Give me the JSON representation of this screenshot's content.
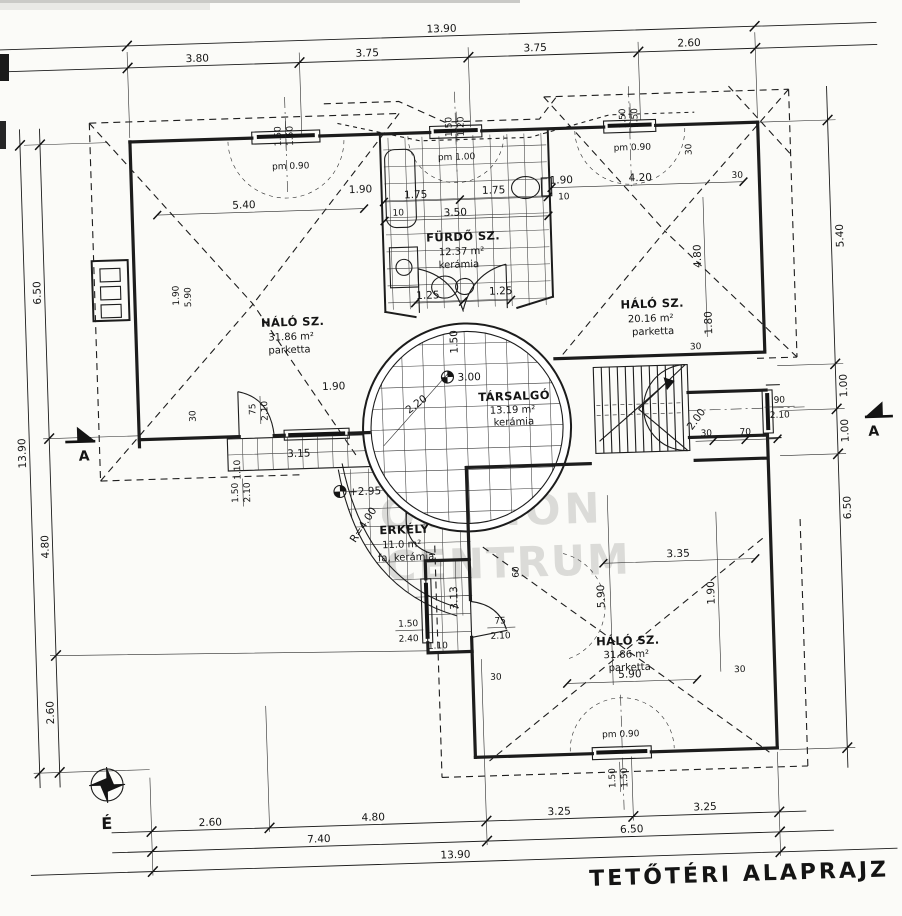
{
  "title": "TETŐTÉRI ALAPRAJZ",
  "compass_label": "É",
  "section_marker": "A",
  "watermark": {
    "logo": "OC",
    "line1": "OTTHON",
    "line2": "CENTRUM"
  },
  "rooms": {
    "bedroom_nw": {
      "name": "HÁLÓ SZ.",
      "area": "31.86 m²",
      "floor": "parketta"
    },
    "bathroom": {
      "name": "FÜRDŐ SZ.",
      "area": "12.37 m²",
      "floor": "kerámia"
    },
    "bedroom_ne": {
      "name": "HÁLÓ SZ.",
      "area": "20.16 m²",
      "floor": "parketta"
    },
    "lounge": {
      "name": "TÁRSALGÓ",
      "area": "13.19 m²",
      "floor": "kerámia"
    },
    "balcony": {
      "name": "ERKÉLY",
      "area": "11.0 m²",
      "floor": "fa, kerámia"
    },
    "bedroom_s": {
      "name": "HÁLÓ SZ.",
      "area": "31.86 m²",
      "floor": "parketta"
    }
  },
  "dims": {
    "top_overall": "13.90",
    "top": [
      "3.80",
      "3.75",
      "3.75",
      "2.60"
    ],
    "left_overall": "13.90",
    "left": [
      "6.50",
      "4.80",
      "2.60"
    ],
    "right": [
      "5.40",
      "1.00",
      "1.00",
      "6.50"
    ],
    "bottom_row1": [
      "2.60",
      "4.80",
      "3.25",
      "3.25"
    ],
    "bottom_row2": [
      "7.40",
      "6.50"
    ],
    "bottom_overall": "13.90"
  },
  "openings": {
    "win_nw": {
      "w": "1.50",
      "h": "1.50",
      "sill": "pm 0.90"
    },
    "win_bath": {
      "w": "1.50",
      "h": "1.20",
      "sill": "pm 1.00"
    },
    "win_ne": {
      "w": "1.50",
      "h": "1.50",
      "sill": "pm 0.90"
    },
    "win_s": {
      "w": "1.50",
      "h": "1.50",
      "sill": "pm 0.90"
    },
    "door_terrace": {
      "w": "75",
      "h": "2.10"
    },
    "win_terrace": {
      "w": "1.50",
      "h": "2.10"
    },
    "door_balcony": {
      "w": "75",
      "h": "2.10"
    },
    "win_balcony": {
      "w": "1.50",
      "h": "2.40"
    },
    "win_stair": {
      "w": "90",
      "h": "2.10"
    }
  },
  "marks": {
    "level_lounge": "3.00",
    "level_balcony": "+2.95",
    "radius": "R=4.00",
    "stair_run": "2.00",
    "lounge_diag": "2.20"
  },
  "inline": {
    "nw": {
      "width": "5.40",
      "d190": "1.90",
      "d10": "10",
      "d190b": "1.90",
      "d590": "5.90"
    },
    "bath": {
      "left": "1.75",
      "right": "1.75",
      "width": "3.50",
      "d190": "1.90",
      "d10": "10"
    },
    "ne": {
      "width": "4.20",
      "t30_top": "30",
      "t30_right": "30",
      "t30_bottom": "30",
      "height": "4.80",
      "d180": "1.80"
    },
    "lounge": {
      "d125a": "1.25",
      "d125b": "1.25",
      "d150": "1.50"
    },
    "terrace": {
      "d190": "1.90",
      "width": "3.15",
      "d110": "1.10",
      "t30": "30"
    },
    "balcony": {
      "h313": "3.13",
      "d60": "60",
      "d110": "1.10",
      "t30": "30"
    },
    "stairs": {
      "t30": "30",
      "t70": "70"
    },
    "s": {
      "w335": "3.35",
      "h590": "5.90",
      "d190": "1.90",
      "w590": "5.90",
      "t30r": "30"
    }
  }
}
